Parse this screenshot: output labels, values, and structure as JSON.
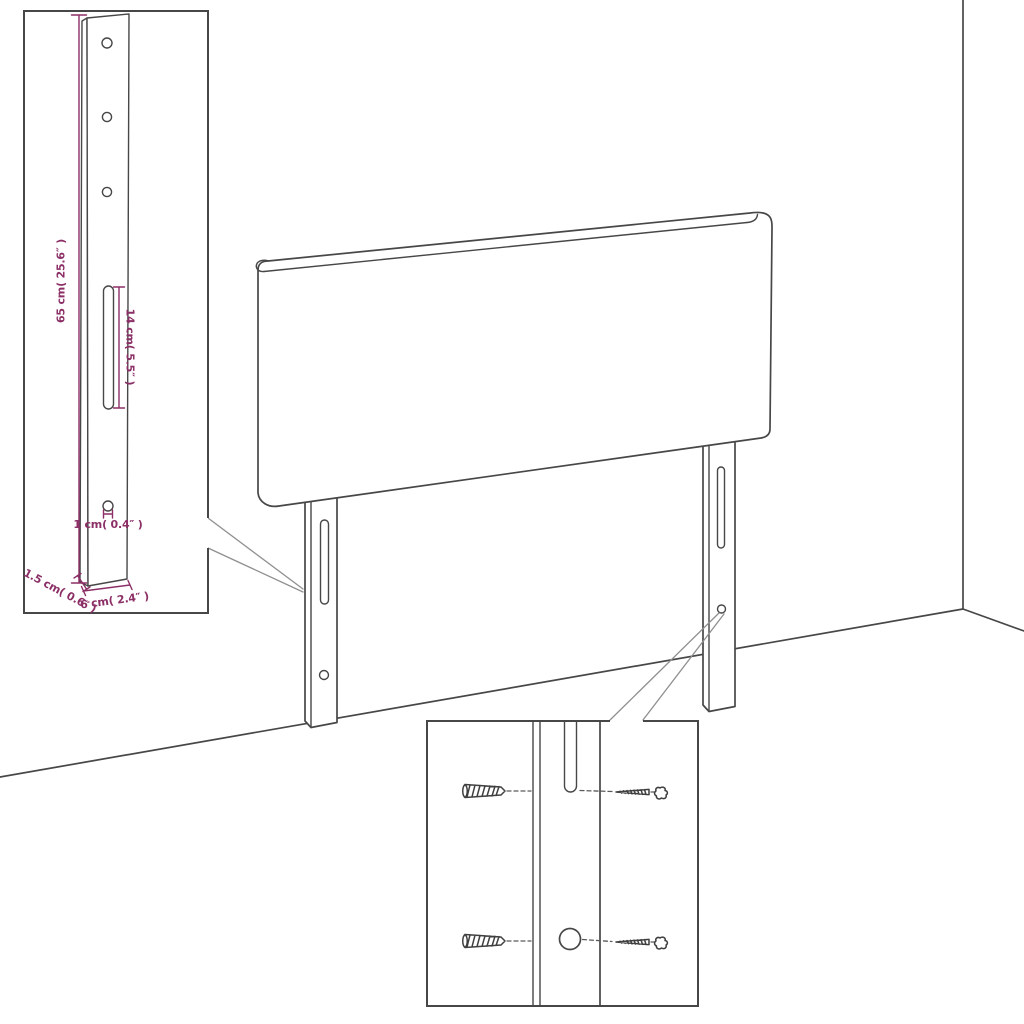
{
  "colors": {
    "dimension": "#8b2f66",
    "line": "#474747",
    "callout": "#8f8f8f",
    "background": "#ffffff"
  },
  "dims": {
    "height": "65 cm( 25.6″ )",
    "slot_length": "14 cm( 5.5″ )",
    "hole_diameter": "1 cm( 0.4″ )",
    "thickness": "1.5 cm( 0.6″ )",
    "width": "6 cm( 2.4″ )"
  },
  "icons": {
    "wall_plug_icon": "ribbed wall anchor (sketch)",
    "screw_icon": "round-head screw (sketch)"
  }
}
